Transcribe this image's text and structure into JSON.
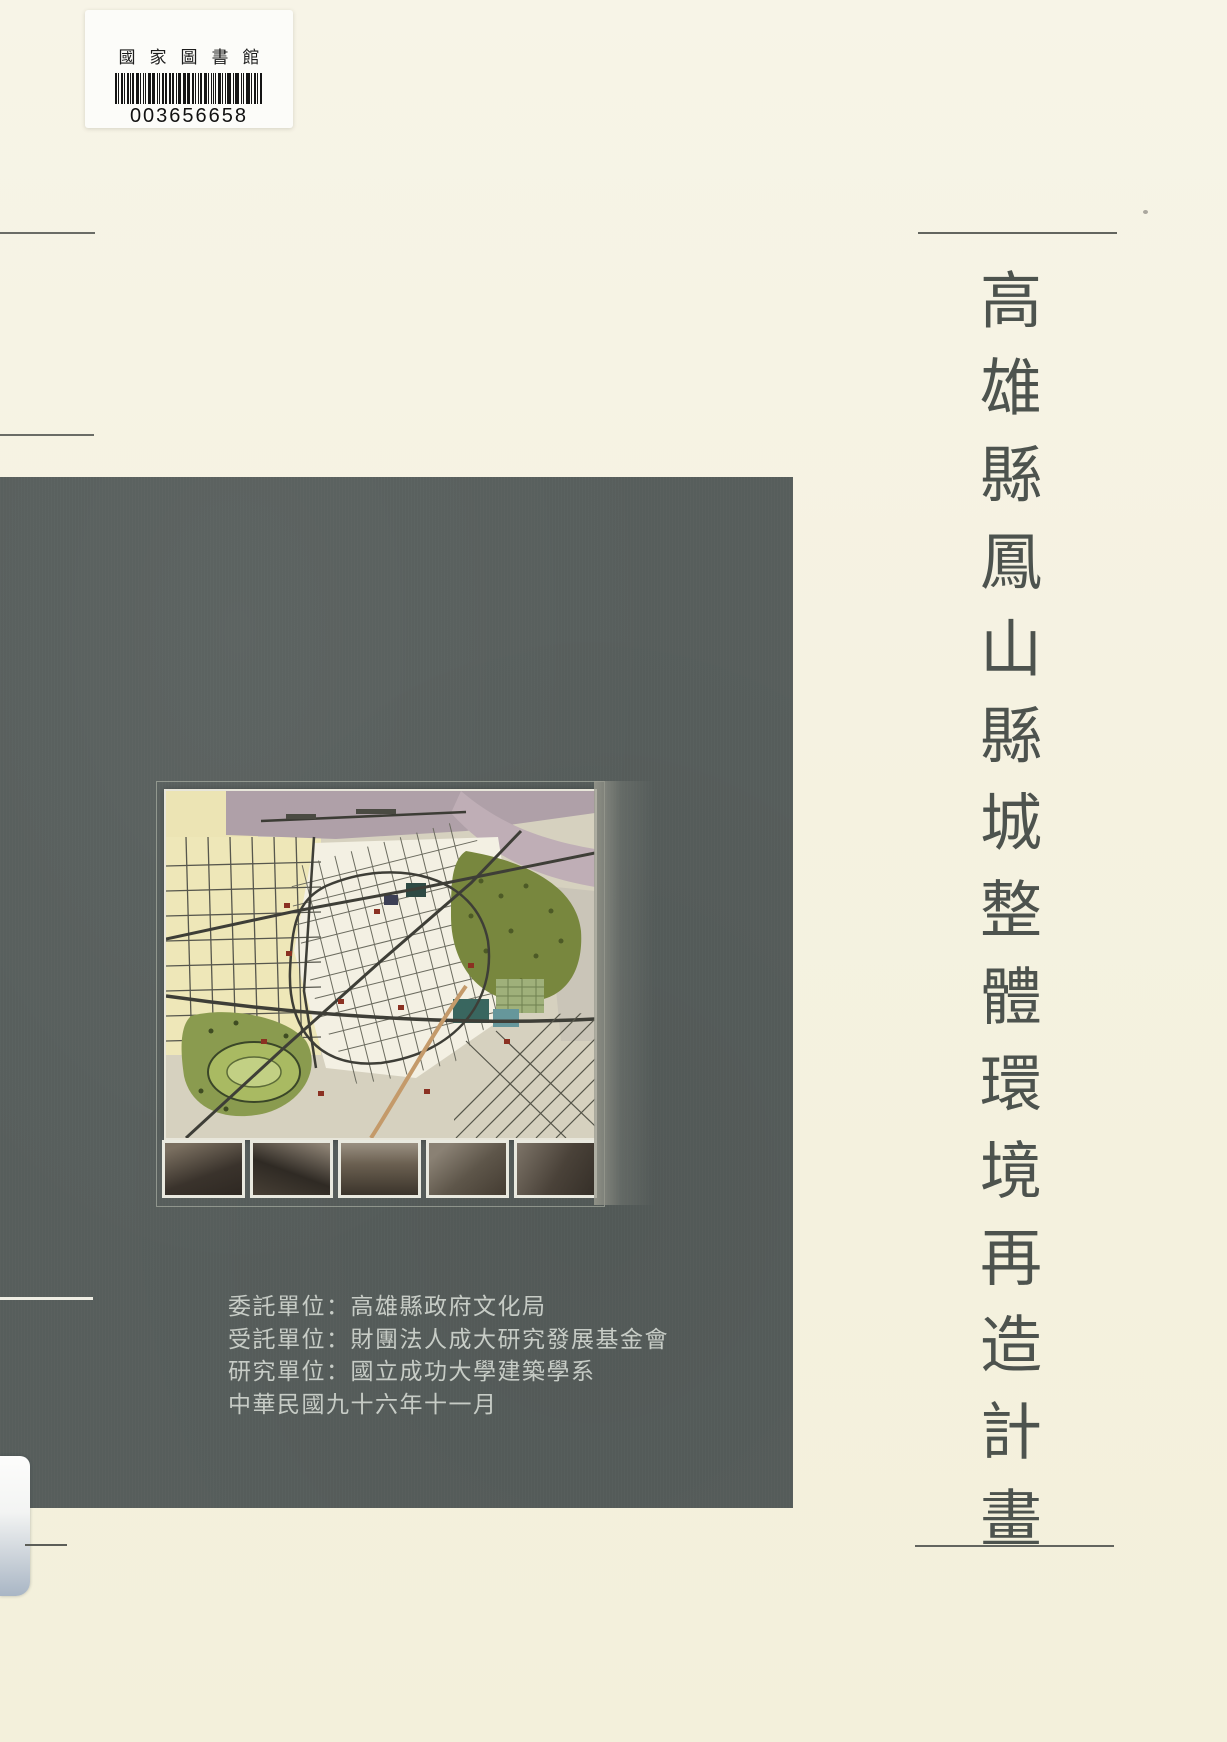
{
  "document": {
    "kind": "scanned-book-cover",
    "title_vertical": "高雄縣鳳山縣城整體環境再造計畫",
    "library_label": {
      "institution": "國家圖書館",
      "barcode_number": "003656658"
    },
    "credits": {
      "lines": [
        "委託單位：高雄縣政府文化局",
        "受託單位：財團法人成大研究發展基金會",
        "研究單位：國立成功大學建築學系",
        "中華民國九十六年十一月"
      ]
    },
    "cover_image": {
      "description": "fengshan-old-city-plan-map",
      "photo_count": 5
    },
    "colors": {
      "page_background": "#f5f2e1",
      "panel": "#575e5c",
      "title_text": "#4d534e",
      "credits_text": "#c7ccc6"
    }
  }
}
